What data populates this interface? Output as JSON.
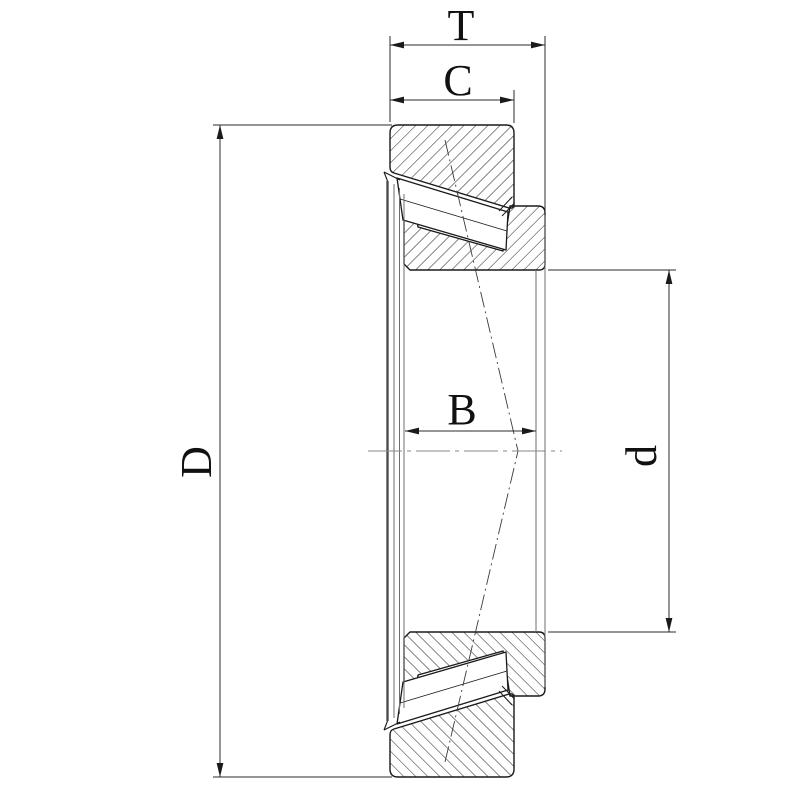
{
  "drawing": {
    "type": "tapered-roller-bearing-cross-section",
    "labels": {
      "total_width": "T",
      "cup_width": "C",
      "cone_width": "B",
      "outer_diameter": "D",
      "bore_diameter": "d"
    },
    "colors": {
      "ink": "#1a1a1a",
      "dimension": "#2b2b2b",
      "projection": "#6e6e6e",
      "centerline": "#8a8a8a",
      "background": "#ffffff"
    }
  }
}
